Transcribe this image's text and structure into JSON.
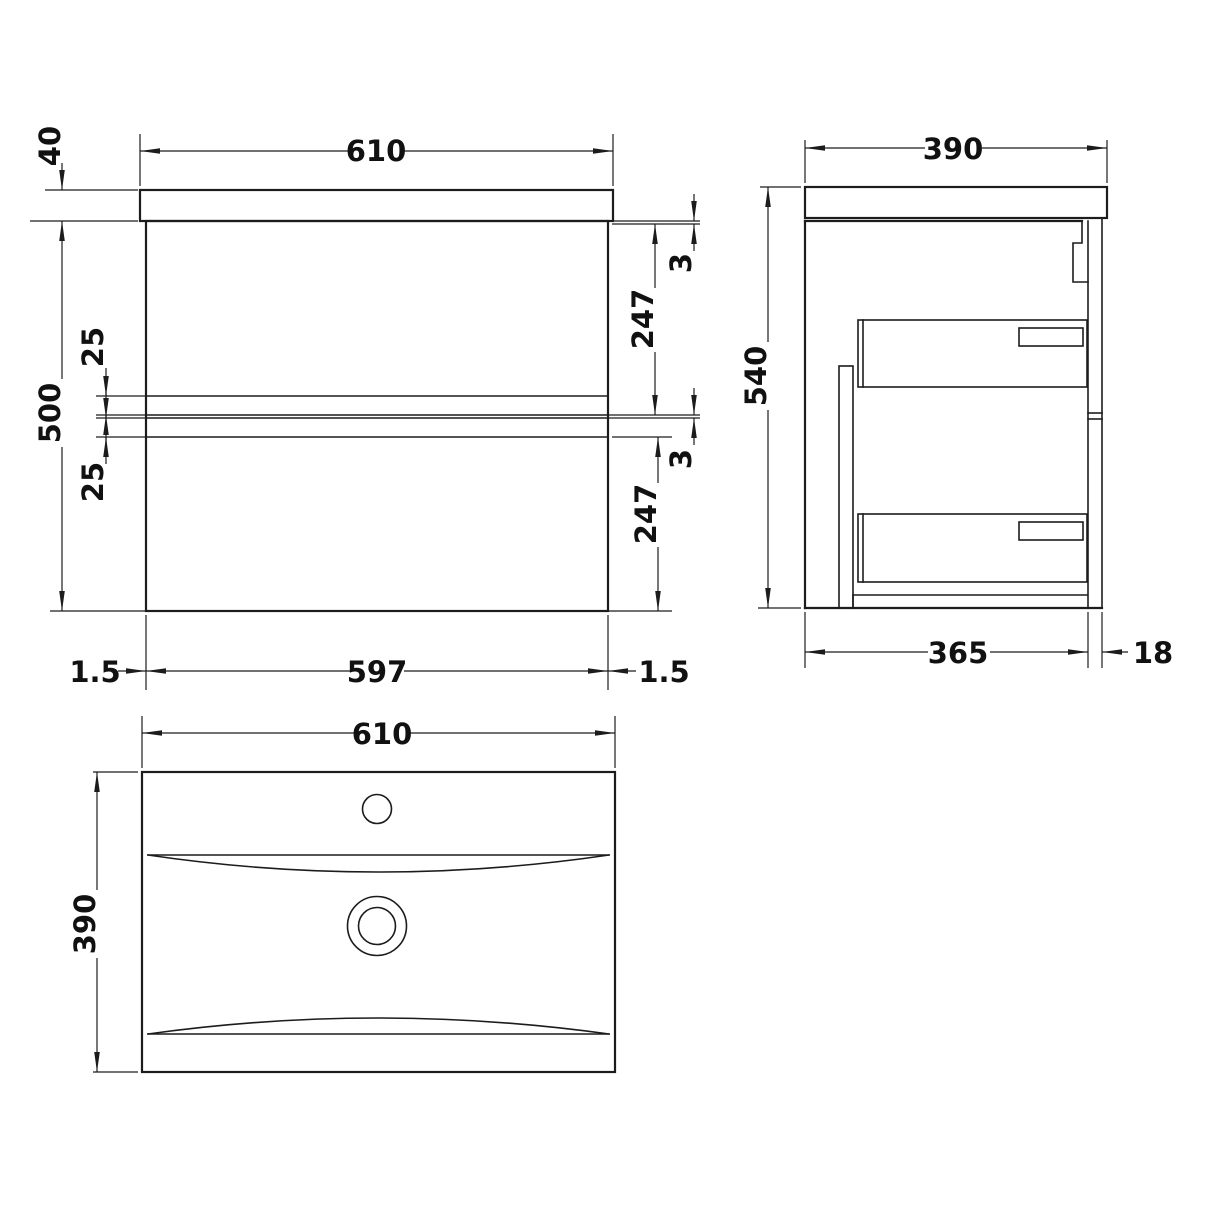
{
  "drawing": {
    "type": "technical-dimension-drawing",
    "subject": "wall-hung two-drawer vanity unit with basin",
    "units": "mm",
    "colors": {
      "line": "#1c1c1c",
      "background": "#ffffff"
    },
    "front_view": {
      "dimensions": {
        "overall_width": "610",
        "counter_thickness": "40",
        "cabinet_height": "500",
        "rail_gap_upper": "25",
        "rail_gap_lower": "25",
        "top_reveal": "3",
        "drawer_front_upper": "247",
        "mid_reveal": "3",
        "drawer_front_lower": "247",
        "side_offset_left": "1.5",
        "cabinet_width": "597",
        "side_offset_right": "1.5"
      }
    },
    "side_view": {
      "dimensions": {
        "overall_depth": "390",
        "overall_height": "540",
        "cabinet_depth": "365",
        "back_rail_thickness": "18"
      }
    },
    "plan_view": {
      "dimensions": {
        "basin_width": "610",
        "basin_depth": "390"
      }
    }
  }
}
